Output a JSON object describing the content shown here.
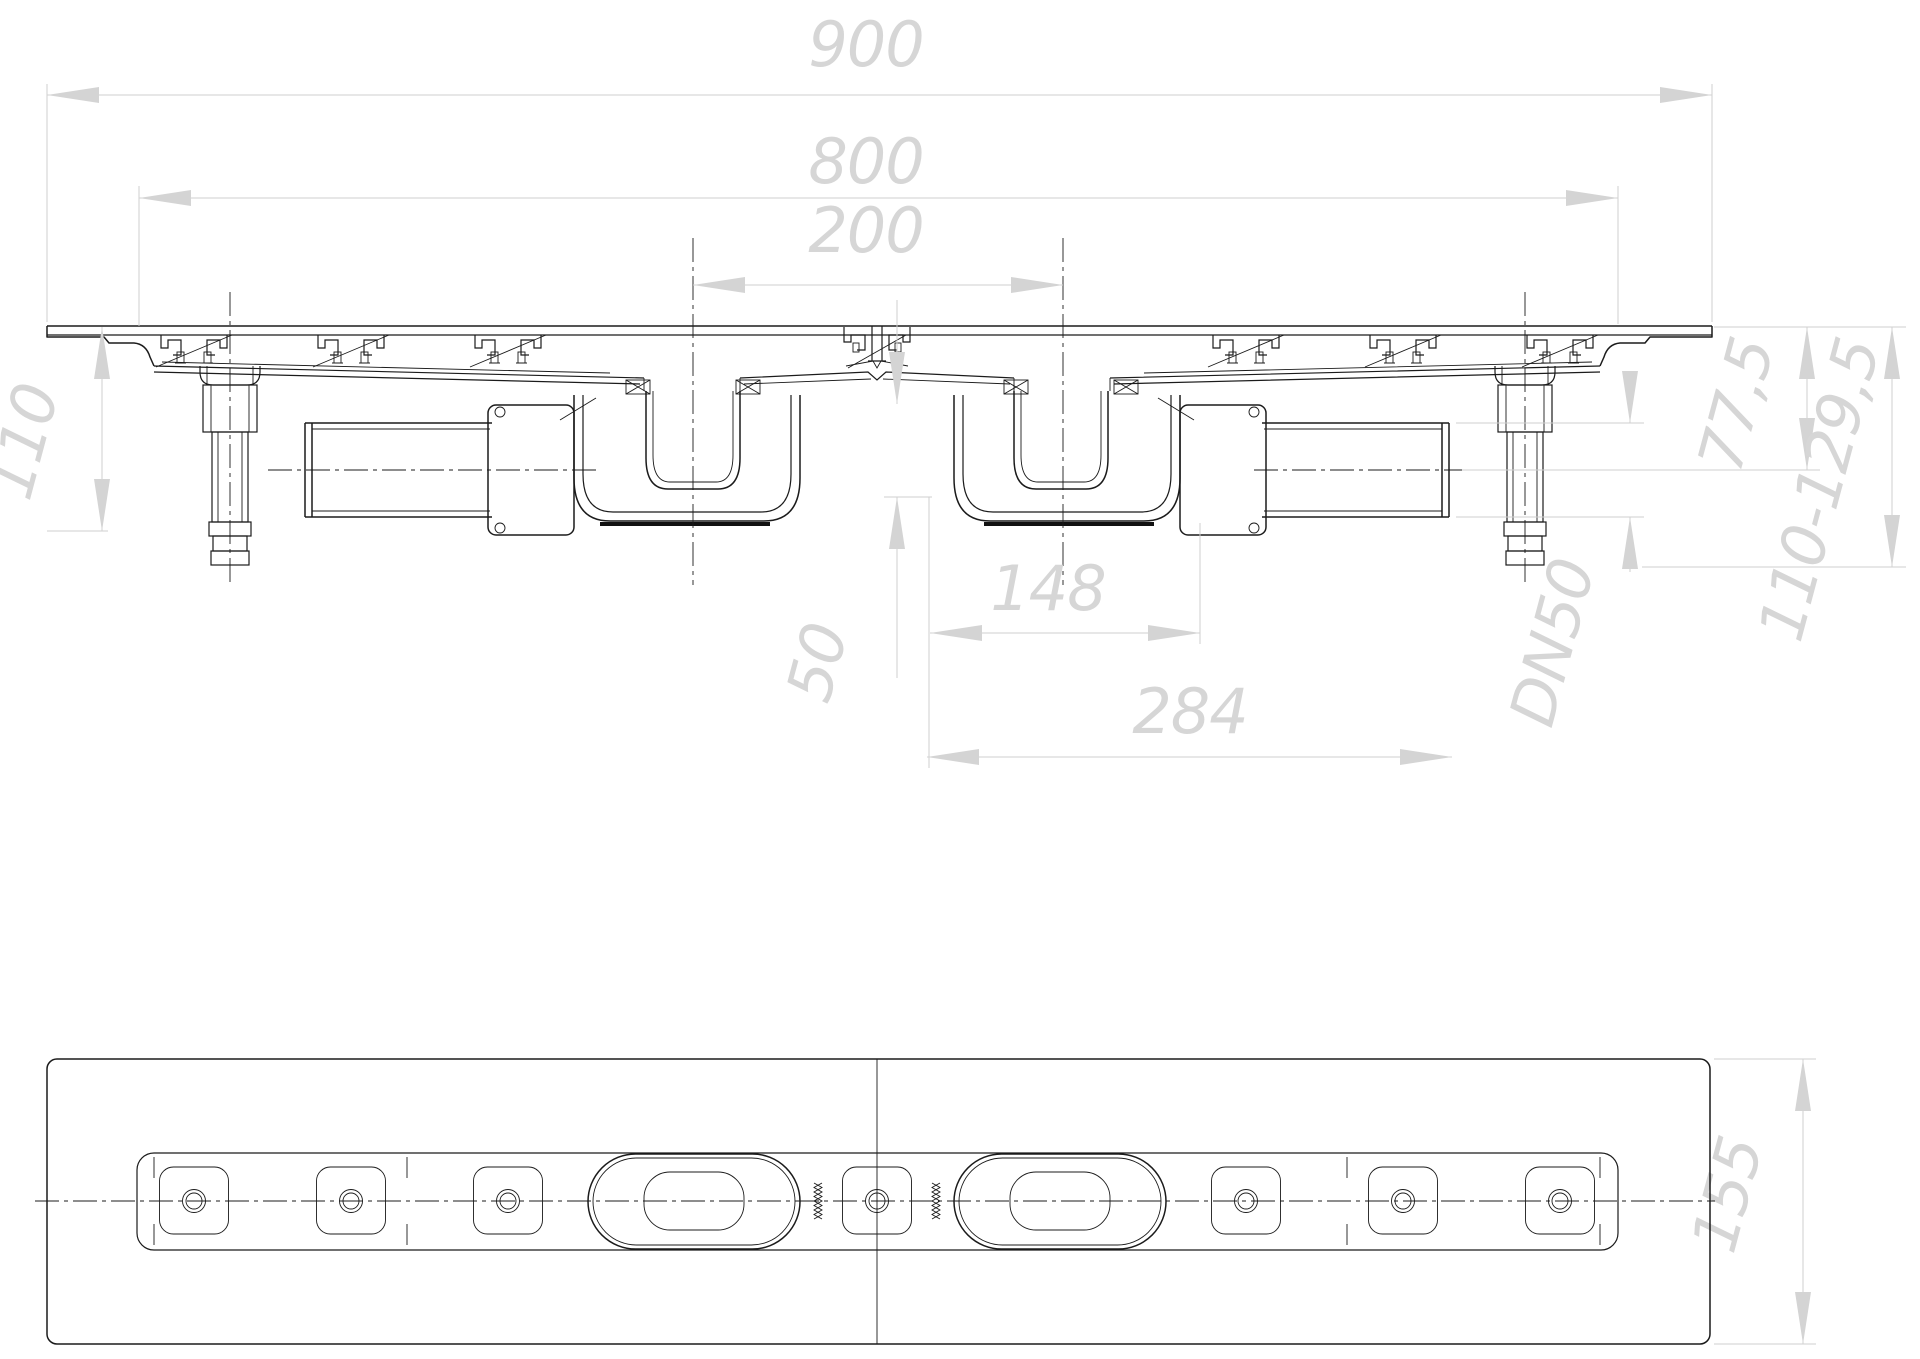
{
  "drawing": {
    "type": "technical-drawing",
    "subject": "shower-drain-channel-with-two-traps",
    "colors": {
      "background": "#ffffff",
      "geometry_line": "#1b1b1b",
      "dimension_line": "#cfcfcf",
      "dimension_text": "#d6d6d6"
    },
    "dims": {
      "overall_length": {
        "label": "900"
      },
      "body_length": {
        "label": "800"
      },
      "outlet_spacing": {
        "label": "200"
      },
      "install_height": {
        "label": "110"
      },
      "seal_depth": {
        "label": "50"
      },
      "trap_width": {
        "label": "148"
      },
      "trap_assembly_length": {
        "label": "284"
      },
      "top_to_pipe_axis": {
        "label": "77,5"
      },
      "adjustable_height": {
        "label": "110-129,5"
      },
      "outlet_diameter": {
        "label": "DN50"
      },
      "base_depth": {
        "label": "155"
      }
    }
  }
}
